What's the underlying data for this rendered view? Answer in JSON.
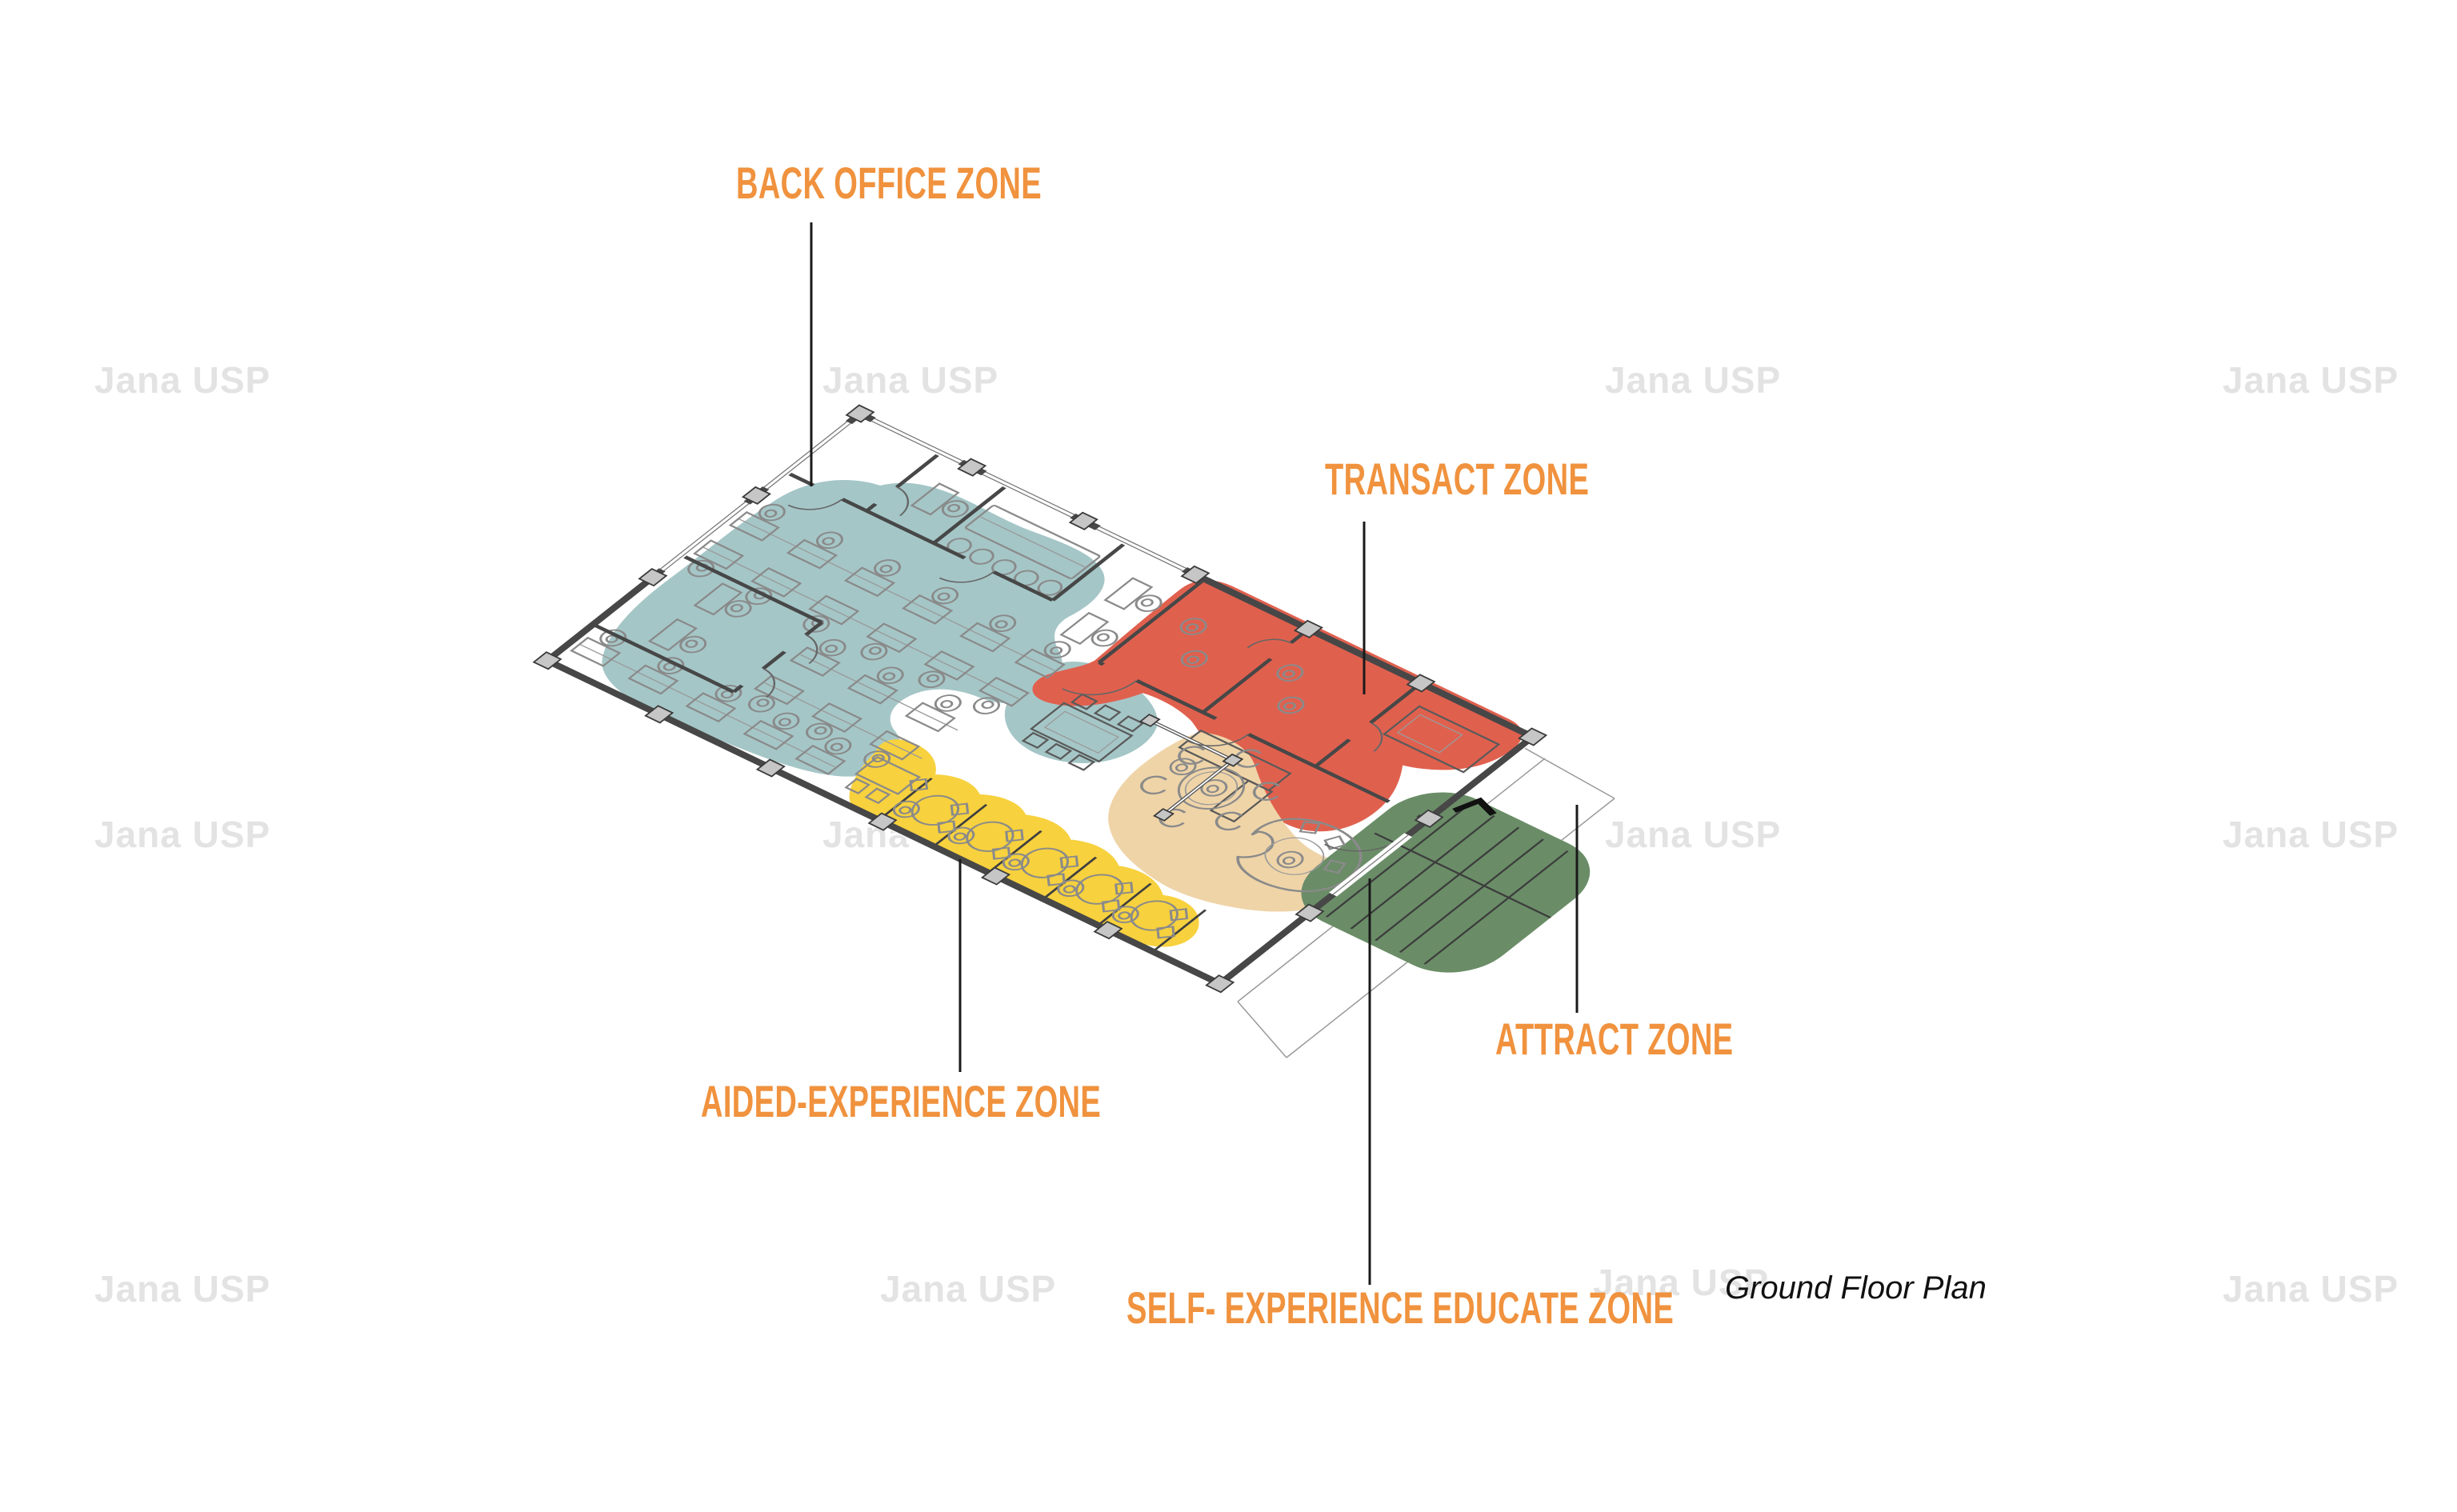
{
  "caption": {
    "text": "Ground Floor Plan",
    "color": "#111111"
  },
  "watermark": {
    "text": "Jana USP",
    "color": "#E3E3E3"
  },
  "label_style": {
    "color": "#F0923E"
  },
  "zones": {
    "back_office": {
      "label": "BACK OFFICE ZONE",
      "color": "#A5C6C7"
    },
    "transact": {
      "label": "TRANSACT ZONE",
      "color": "#E0604E"
    },
    "aided_experience": {
      "label": "AIDED-EXPERIENCE ZONE",
      "color": "#F7D13E"
    },
    "self_experience_educate": {
      "label": "SELF- EXPERIENCE EDUCATE ZONE",
      "color": "#EFD4A8"
    },
    "attract": {
      "label": "ATTRACT ZONE",
      "color": "#6A8D67"
    }
  }
}
